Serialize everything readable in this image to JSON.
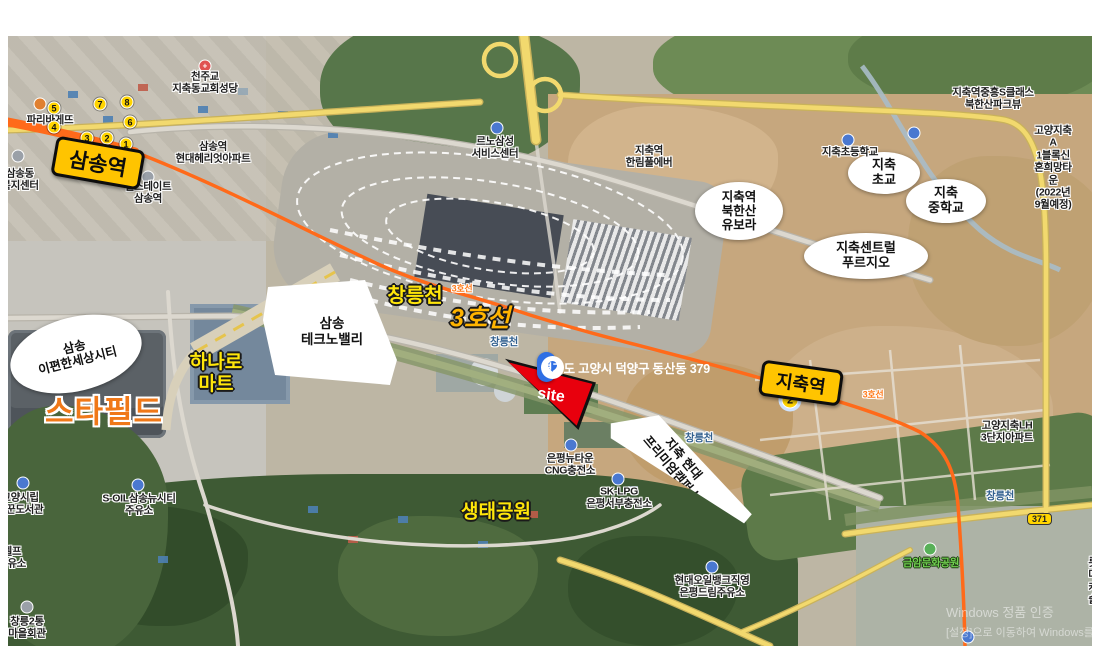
{
  "map_title": "satellite map annotation - Samsong / Jichuk area",
  "colors": {
    "line3_orange": "#ff6a1a",
    "station_yellow": "#ffc400",
    "address_blue": "#2f6fe4",
    "site_red": "#e8000d",
    "big_label_yellow": "#ffe60a",
    "starfield_orange": "#f07818"
  },
  "stations": {
    "samsong": {
      "label": "삼송역"
    },
    "jichuk": {
      "label": "지축역"
    }
  },
  "exits": {
    "samsong": [
      {
        "n": "5"
      },
      {
        "n": "4"
      },
      {
        "n": "7"
      },
      {
        "n": "8"
      },
      {
        "n": "6"
      },
      {
        "n": "3"
      },
      {
        "n": "2"
      },
      {
        "n": "1"
      }
    ],
    "jichuk": [
      {
        "n": "2"
      }
    ]
  },
  "address": {
    "text": "경기도 고양시 덕양구 동산동 379"
  },
  "site": {
    "label": "site"
  },
  "big_labels": [
    {
      "id": "changneung-stream",
      "text": "창릉천"
    },
    {
      "id": "line3",
      "text": "3호선"
    },
    {
      "id": "hanaro-mart",
      "text": "하나로\n마트"
    },
    {
      "id": "eco-park",
      "text": "생태공원"
    },
    {
      "id": "starfield",
      "text": "스타필드"
    }
  ],
  "ellipses": [
    {
      "text": "삼송\n이편한세상시티"
    },
    {
      "text": "지축역\n북한산\n유보라"
    },
    {
      "text": "지축센트럴\n푸르지오"
    },
    {
      "text": "지축\n초교"
    },
    {
      "text": "지축\n중학교"
    }
  ],
  "polygons": [
    {
      "text": "삼송\n테크노밸리"
    },
    {
      "text": "지축 현대\n프리미엄캠퍼스"
    }
  ],
  "pois": [
    {
      "text": "천주교\n지축동교회성당"
    },
    {
      "text": "파리바게뜨"
    },
    {
      "text": "삼송역\n현대헤리엇아파트"
    },
    {
      "text": "힐스테이트\n삼송역"
    },
    {
      "text": "삼송동\n복지센터"
    },
    {
      "text": "르노삼성\n서비스센터"
    },
    {
      "text": "지축역\n한림풀에버"
    },
    {
      "text": "지축초등학교"
    },
    {
      "text": "지축역중흥S클래스\n북한산파크뷰"
    },
    {
      "text": "고양지축A\n1블록신혼희망타운\n(2022년9월예정)"
    },
    {
      "text": "고양지축LH\n3단지아파트"
    },
    {
      "text": "창릉천"
    },
    {
      "text": "창릉천"
    },
    {
      "text": "창릉천"
    },
    {
      "text": "3호선"
    },
    {
      "text": "3호선"
    },
    {
      "text": "은평뉴타운\nCNG충전소"
    },
    {
      "text": "SK-LPG\n은평서부충전소"
    },
    {
      "text": "현대오일뱅크직영\n은평드림주유소"
    },
    {
      "text": "S-OIL삼송뉴시티\n주유소"
    },
    {
      "text": "고양시립\n꿈꾼도서관"
    },
    {
      "text": "셀프\n주유소"
    },
    {
      "text": "창릉2통\n마을회관"
    },
    {
      "text": "금암문화공원"
    },
    {
      "text": "롯데캐슬"
    }
  ],
  "road_badge": "371",
  "watermark": {
    "line1": "Windows 정품 인증",
    "line2": "[설정]으로 이동하여 Windows를 정품 인증합니다."
  }
}
